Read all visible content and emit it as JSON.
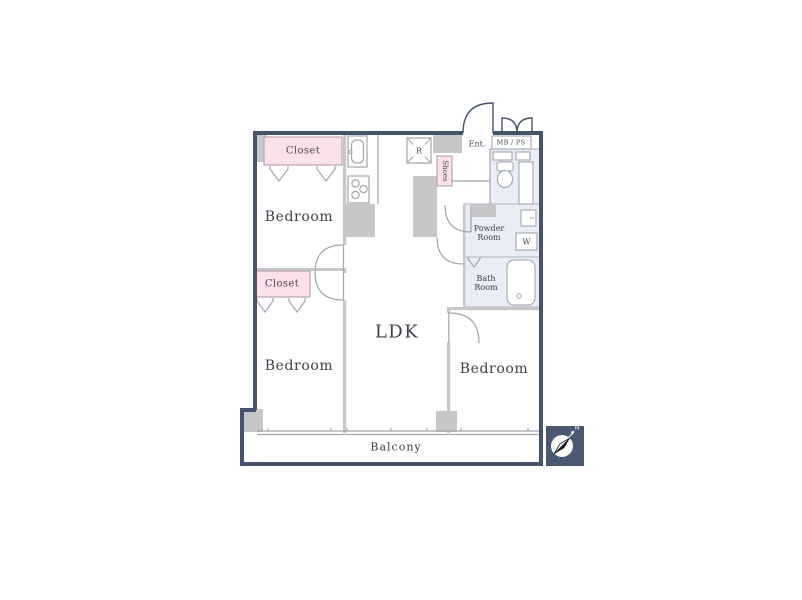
{
  "floor_plan": {
    "type": "apartment-floor-plan",
    "labels": {
      "closet_top": "Closet",
      "bedroom_top_left": "Bedroom",
      "closet_middle": "Closet",
      "bedroom_bottom_left": "Bedroom",
      "ldk": "LDK",
      "bedroom_bottom_right": "Bedroom",
      "balcony": "Balcony",
      "entrance": "Ent.",
      "meter_box_pipe_space": "MB / PS",
      "refrigerator_space": "R",
      "shoes_box": "Shoes",
      "powder_room": "Powder Room",
      "washer": "W",
      "bath_room": "Bath Room"
    },
    "compass": {
      "north_label": "N",
      "direction": "north-east"
    },
    "colors": {
      "outer_wall": "#47536d",
      "inner_wall": "#c7c7ca",
      "closet_fill": "#fbe1ea",
      "closet_border": "#b394a4",
      "wet_area_fill": "#e9edf5",
      "wet_area_border": "#aab3c6",
      "line": "#a5a5ab",
      "text": "#3f4049",
      "compass_square": "#4a5872"
    }
  }
}
